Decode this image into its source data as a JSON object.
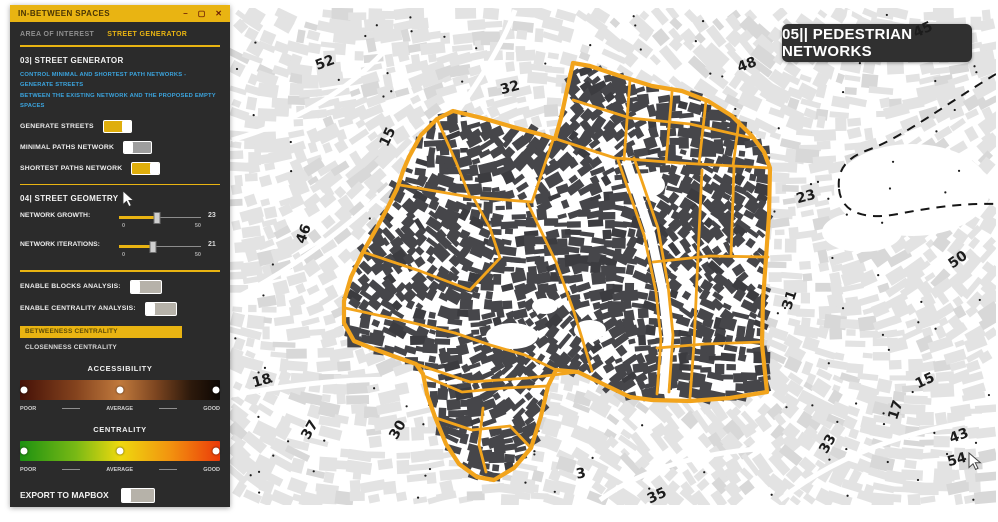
{
  "window": {
    "title": "IN-BETWEEN SPACES",
    "minimize": "–",
    "maximize": "▢",
    "close": "✕"
  },
  "tabs": {
    "area": "AREA OF INTEREST",
    "street": "STREET GENERATOR"
  },
  "generator": {
    "heading": "03| STREET GENERATOR",
    "desc1": "CONTROL MINIMAL AND SHORTEST PATH NETWORKS - GENERATE STREETS",
    "desc2": "BETWEEN THE EXISTING NETWORK AND THE PROPOSED EMPTY SPACES",
    "toggles": [
      {
        "label": "GENERATE STREETS",
        "on": true
      },
      {
        "label": "MINIMAL PATHS NETWORK",
        "on": false
      },
      {
        "label": "SHORTEST PATHS NETWORK",
        "on": true
      }
    ]
  },
  "geometry": {
    "heading": "04| STREET GEOMETRY",
    "sliders": [
      {
        "label": "NETWORK GROWTH:",
        "min": "0",
        "max": "50",
        "value": "23",
        "pct": 46
      },
      {
        "label": "NETWORK ITERATIONS:",
        "min": "0",
        "max": "50",
        "value": "21",
        "pct": 42
      }
    ]
  },
  "analysis": {
    "toggles": [
      {
        "label": "ENABLE BLOCKS ANALYSIS:",
        "on": false
      },
      {
        "label": "ENABLE CENTRALITY ANALYSIS:",
        "on": false
      }
    ],
    "selected": "BETWEENESS CENTRALITY",
    "option": "CLOSENNESS CENTRALITY"
  },
  "accessibility": {
    "title": "ACCESSIBILITY",
    "poor": "POOR",
    "avg": "AVERAGE",
    "good": "GOOD",
    "gradient": "background:linear-gradient(90deg,#451107 0%,#84431e 28%,#c17a3d 50%,#7c4520 68%,#2e1a0c 85%,#0d0703 100%)"
  },
  "centrality_legend": {
    "title": "CENTRALITY",
    "poor": "POOR",
    "avg": "AVERAGE",
    "good": "GOOD",
    "gradient": "background:linear-gradient(90deg,#1d9111 0%,#79b915 28%,#eed90f 50%,#f2930f 75%,#eb3a0a 100%)"
  },
  "export": {
    "label": "EXPORT TO MAPBOX",
    "on": false
  },
  "map": {
    "badge": "05|| PEDESTRIAN NETWORKS",
    "street_color": "#F2A41C",
    "building_dark": "#46464a",
    "building_light": "#e3e3e3",
    "annotations": [
      {
        "label": "52",
        "x": 325,
        "y": 63,
        "rot": -20
      },
      {
        "label": "32",
        "x": 510,
        "y": 88,
        "rot": -15
      },
      {
        "label": "15",
        "x": 388,
        "y": 137,
        "rot": -65
      },
      {
        "label": "48",
        "x": 747,
        "y": 65,
        "rot": -20
      },
      {
        "label": "45",
        "x": 923,
        "y": 30,
        "rot": -25
      },
      {
        "label": "23",
        "x": 806,
        "y": 197,
        "rot": -15
      },
      {
        "label": "46",
        "x": 304,
        "y": 234,
        "rot": -70
      },
      {
        "label": "50",
        "x": 958,
        "y": 260,
        "rot": -35
      },
      {
        "label": "31",
        "x": 790,
        "y": 300,
        "rot": -72
      },
      {
        "label": "18",
        "x": 262,
        "y": 381,
        "rot": -15
      },
      {
        "label": "37",
        "x": 310,
        "y": 430,
        "rot": -60
      },
      {
        "label": "30",
        "x": 398,
        "y": 430,
        "rot": -60
      },
      {
        "label": "15",
        "x": 925,
        "y": 381,
        "rot": -25
      },
      {
        "label": "17",
        "x": 896,
        "y": 410,
        "rot": -72
      },
      {
        "label": "33",
        "x": 828,
        "y": 444,
        "rot": -60
      },
      {
        "label": "43",
        "x": 959,
        "y": 436,
        "rot": -20
      },
      {
        "label": "54",
        "x": 957,
        "y": 460,
        "rot": -15
      },
      {
        "label": "3",
        "x": 581,
        "y": 474,
        "rot": -10
      },
      {
        "label": "35",
        "x": 657,
        "y": 496,
        "rot": -25
      }
    ]
  }
}
